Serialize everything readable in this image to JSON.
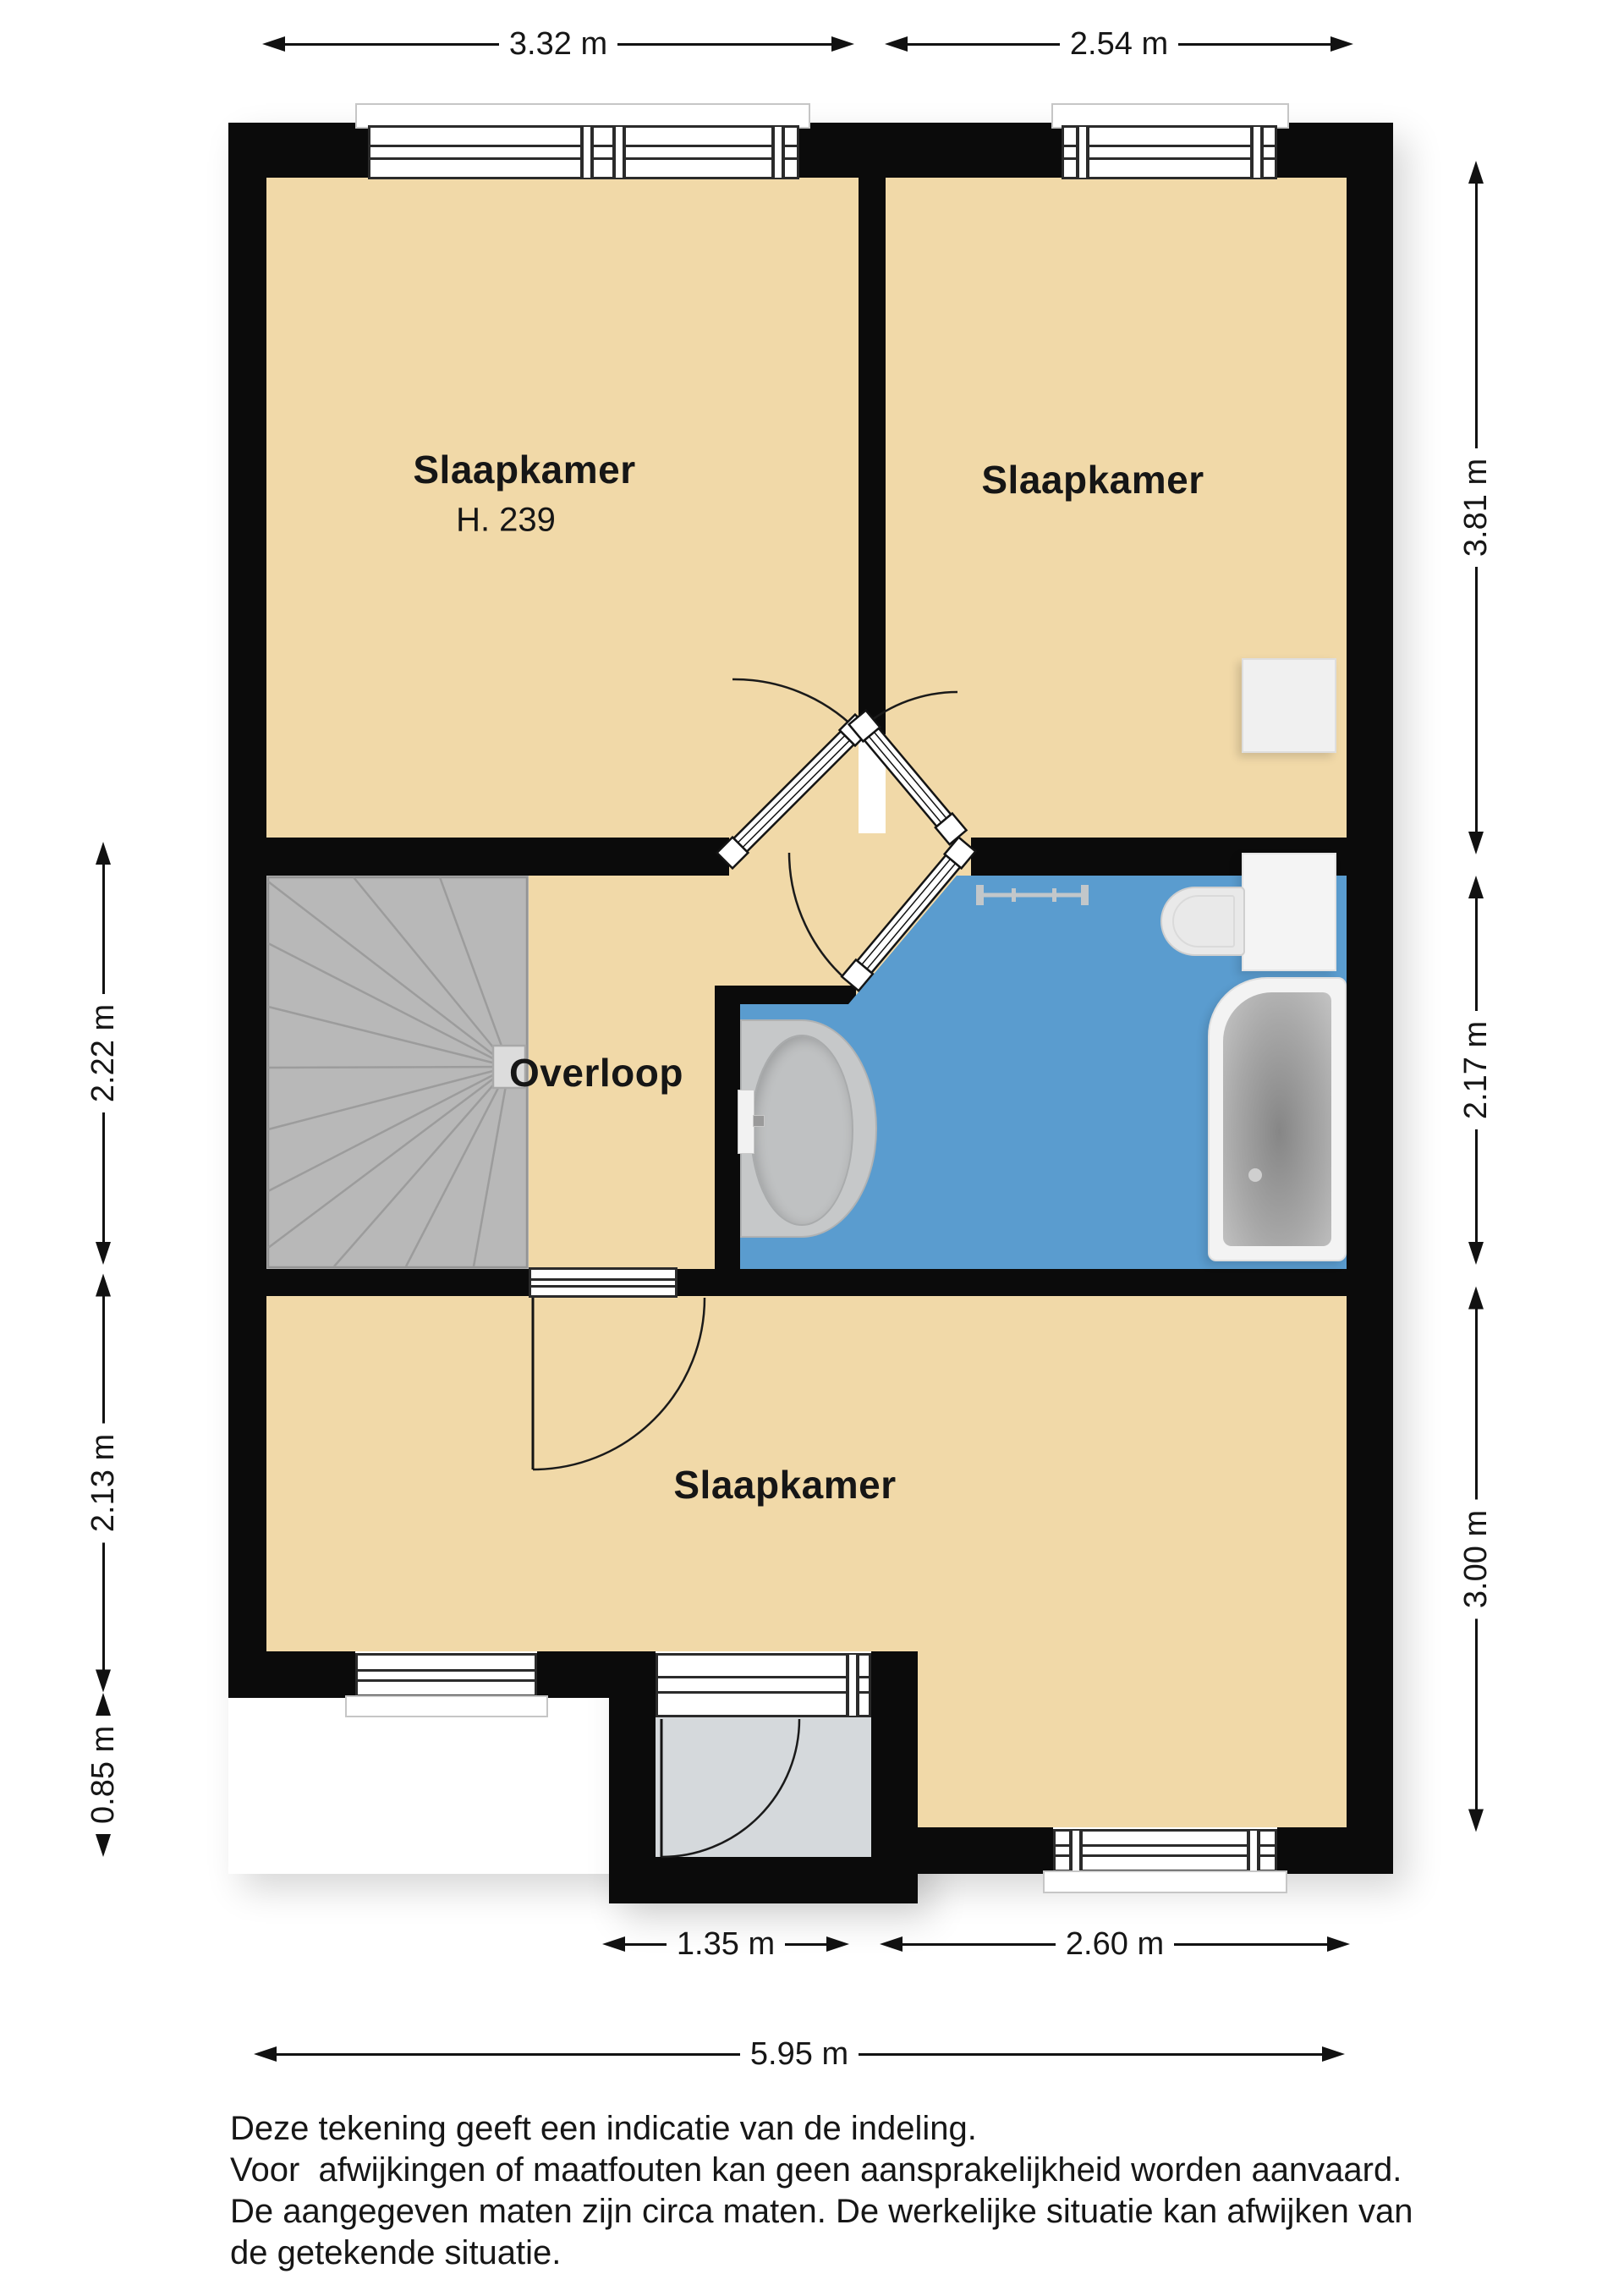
{
  "document": {
    "type": "floor-plan",
    "floor": "upper"
  },
  "rooms": {
    "bedroom_top_left": {
      "label": "Slaapkamer",
      "height_note": "H. 239"
    },
    "bedroom_top_right": {
      "label": "Slaapkamer"
    },
    "landing": {
      "label": "Overloop"
    },
    "bedroom_bottom": {
      "label": "Slaapkamer"
    }
  },
  "dimensions": {
    "top": [
      {
        "label": "3.32 m"
      },
      {
        "label": "2.54 m"
      }
    ],
    "right": [
      {
        "label": "3.81 m"
      },
      {
        "label": "2.17 m"
      },
      {
        "label": "3.00 m"
      }
    ],
    "left": [
      {
        "label": "2.22 m"
      },
      {
        "label": "2.13 m"
      },
      {
        "label": "0.85 m"
      }
    ],
    "bottom_inner": [
      {
        "label": "1.35 m"
      },
      {
        "label": "2.60 m"
      }
    ],
    "bottom_total": {
      "label": "5.95 m"
    }
  },
  "fixtures": {
    "stairs": "winder-staircase-icon",
    "bath": "bathtub-icon",
    "toilet": "toilet-icon",
    "sink": "washbasin-icon",
    "towel_rail": "towel-rail-icon",
    "closet": "closet-icon",
    "windows": "window-icon",
    "doors": "door-swing-icon"
  },
  "colors": {
    "floor": "#f1d9a8",
    "bathroom_floor": "#5a9ccf",
    "wall": "#0b0b0b",
    "porch_floor": "#d5d9dc",
    "stairs": "#b8b8b8"
  },
  "disclaimer": {
    "line1": "Deze tekening geeft een indicatie van de indeling.",
    "line2": "Voor  afwijkingen of maatfouten kan geen aansprakelijkheid worden aanvaard.",
    "line3": "De aangegeven maten zijn circa maten. De werkelijke situatie kan afwijken van",
    "line4": "de getekende situatie."
  }
}
